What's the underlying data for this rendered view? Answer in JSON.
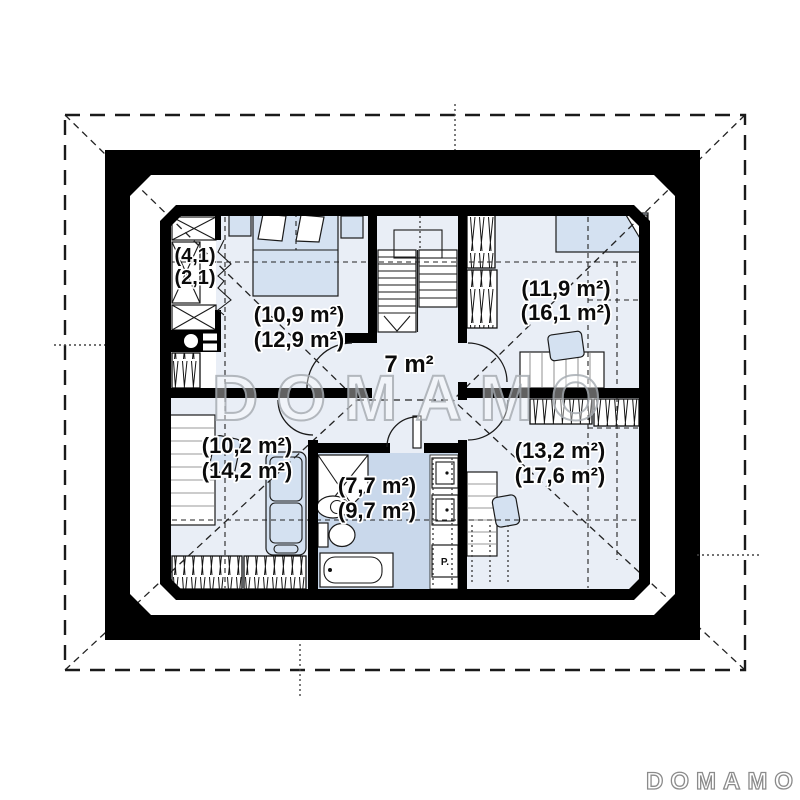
{
  "watermark": "DOMAMO",
  "brand": "DOMAMO",
  "rooms": {
    "closet": {
      "line1": "(4,1)",
      "line2": "(2,1)"
    },
    "bedroom": {
      "line1": "(10,9 m²)",
      "line2": "(12,9 m²)"
    },
    "hall": {
      "line1": "7 m²"
    },
    "room_top_right": {
      "line1": "(11,9 m²)",
      "line2": "(16,1 m²)"
    },
    "room_bottom_left": {
      "line1": "(10,2 m²)",
      "line2": "(14,2 m²)"
    },
    "bathroom": {
      "line1": "(7,7 m²)",
      "line2": "(9,7 m²)"
    },
    "room_bottom_right": {
      "line1": "(13,2 m²)",
      "line2": "(17,6 m²)"
    }
  },
  "appliances": {
    "washing_machine": "P."
  },
  "colors": {
    "wall": "#000000",
    "floor": "#e9eef6",
    "bathroom_floor": "#c9d8eb",
    "furniture_fill": "#d4e1f1",
    "watermark_gray": "#a9aeb4"
  }
}
